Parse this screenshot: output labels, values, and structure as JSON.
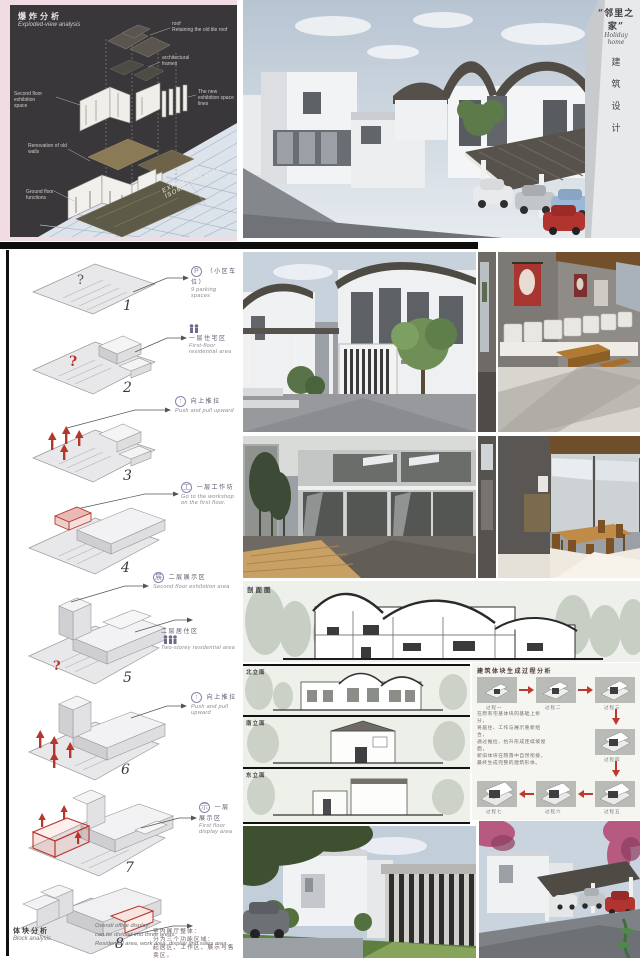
{
  "hero": {
    "corner_title_cn": "“邻里之家”",
    "corner_title_en": "Holiday home",
    "corner_vertical": [
      "建",
      "筑",
      "设",
      "计"
    ]
  },
  "exploded": {
    "title_cn": "爆炸分析",
    "title_en": "Exploded-view analysis",
    "labels": [
      {
        "a": "roof",
        "b": "Retaining the old tile roof"
      },
      {
        "a": "architectural",
        "b": "frames"
      },
      {
        "a": "Second floor exhibition",
        "b": "space"
      },
      {
        "a": "The new exhibition space",
        "b": "lines"
      },
      {
        "a": "Renovation of old",
        "b": "walls"
      },
      {
        "a": "Ground floor",
        "b": "functions"
      }
    ],
    "axon_caption": "EXPLODED ISOMETRIC VIEW"
  },
  "steps": [
    {
      "num": "1",
      "icon": "P",
      "cn": "（小区车位）",
      "en": "9 parking spaces"
    },
    {
      "num": "2",
      "icon": "people",
      "cn": "一层住宅区",
      "en": "First-floor residential area"
    },
    {
      "num": "3",
      "icon": "up",
      "cn": "向上推拉",
      "en": "Push and pull upward"
    },
    {
      "num": "4",
      "icon": "work",
      "cn": "一层工作坊",
      "en": "Go to the workshop on the first floor."
    },
    {
      "num": "5",
      "icon": "exhibit",
      "cn": "二层展示区",
      "en": "Second floor exhibition area",
      "cn2": "二层居住区",
      "en2": "Two-storey residential area"
    },
    {
      "num": "6",
      "icon": "up",
      "cn": "向上推拉",
      "en": "Push and pull upward"
    },
    {
      "num": "7",
      "icon": "display",
      "cn": "一层展示区",
      "en": "First floor display area"
    },
    {
      "num": "8",
      "cn_1": "室内展厅整体：",
      "cn_2": "分为三个功能区域：",
      "cn_3": "起居区、工作区、展示与售卖区。"
    }
  ],
  "left_footer": {
    "cn": "体块分析",
    "en": "Block analysis",
    "en_1": "Overall office display:",
    "en_2": "can be divided into three areas:",
    "en_3": "Residential area, work area, display and sales area."
  },
  "section": {
    "label": "剖面图"
  },
  "elevations": {
    "labels": [
      "北立面",
      "南立面",
      "东立面"
    ]
  },
  "process": {
    "title": "建筑体块生成过程分析",
    "captions": [
      "过程一",
      "过程二",
      "过程三",
      "过程四",
      "过程五",
      "过程六",
      "过程七"
    ],
    "para_1": "在原有宅基体块的基础上拆分，",
    "para_2": "将居住、工作与展示重新组合，",
    "para_3": "通过推拉、抬升形成连续坡屋面，",
    "para_4": "新旧体块在院落中自然衔接，",
    "para_5": "最终生成完整的建筑形体。"
  },
  "colors": {
    "accent_red": "#b5372c",
    "pink": "#f2dce3",
    "dark_panel": "#39373a",
    "roof_dark": "#55504a",
    "grid_blue": "#a9b8ca",
    "icon_purple": "#8585a8"
  }
}
